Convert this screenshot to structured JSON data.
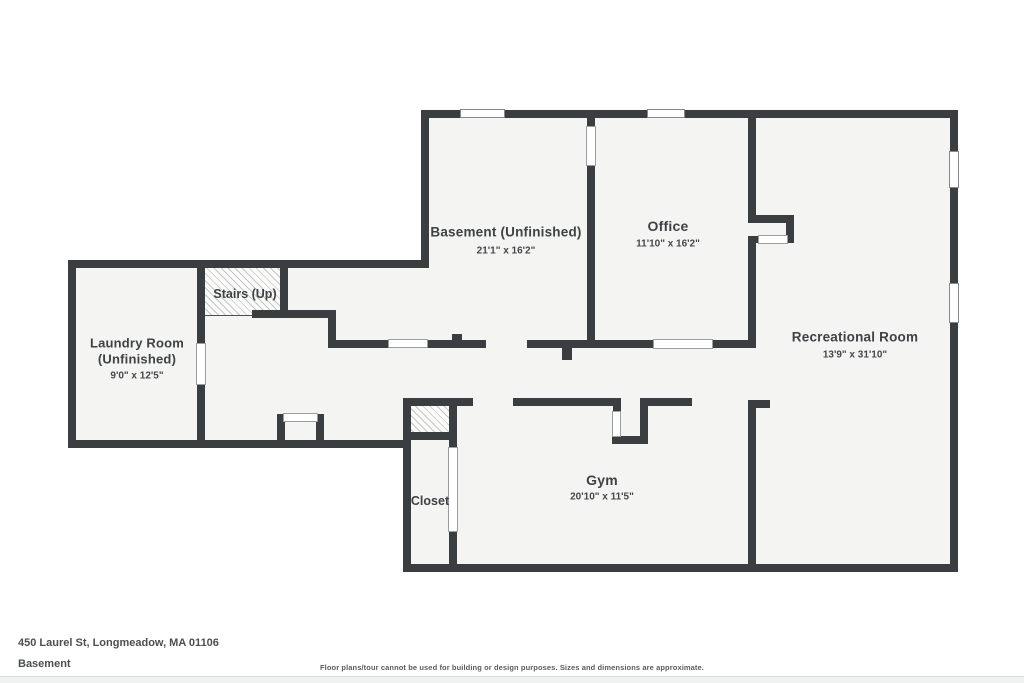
{
  "colors": {
    "wall": "#3a3e41",
    "floor": "#f4f4f3",
    "background": "#ffffff",
    "text": "#3e4245"
  },
  "rooms": {
    "basement": {
      "name": "Basement (Unfinished)",
      "dims": "21'1\" x 16'2\""
    },
    "office": {
      "name": "Office",
      "dims": "11'10\" x 16'2\""
    },
    "recreational": {
      "name": "Recreational Room",
      "dims": "13'9\" x 31'10\""
    },
    "laundry": {
      "name_line1": "Laundry Room",
      "name_line2": "(Unfinished)",
      "dims": "9'0\" x 12'5\""
    },
    "gym": {
      "name": "Gym",
      "dims": "20'10\" x 11'5\""
    },
    "closet": {
      "name": "Closet"
    },
    "stairs": {
      "name": "Stairs (Up)"
    }
  },
  "footer": {
    "address": "450 Laurel St, Longmeadow, MA 01106",
    "floor_label": "Basement",
    "disclaimer": "Floor plans/tour cannot be used for building or design purposes. Sizes and dimensions are approximate."
  }
}
